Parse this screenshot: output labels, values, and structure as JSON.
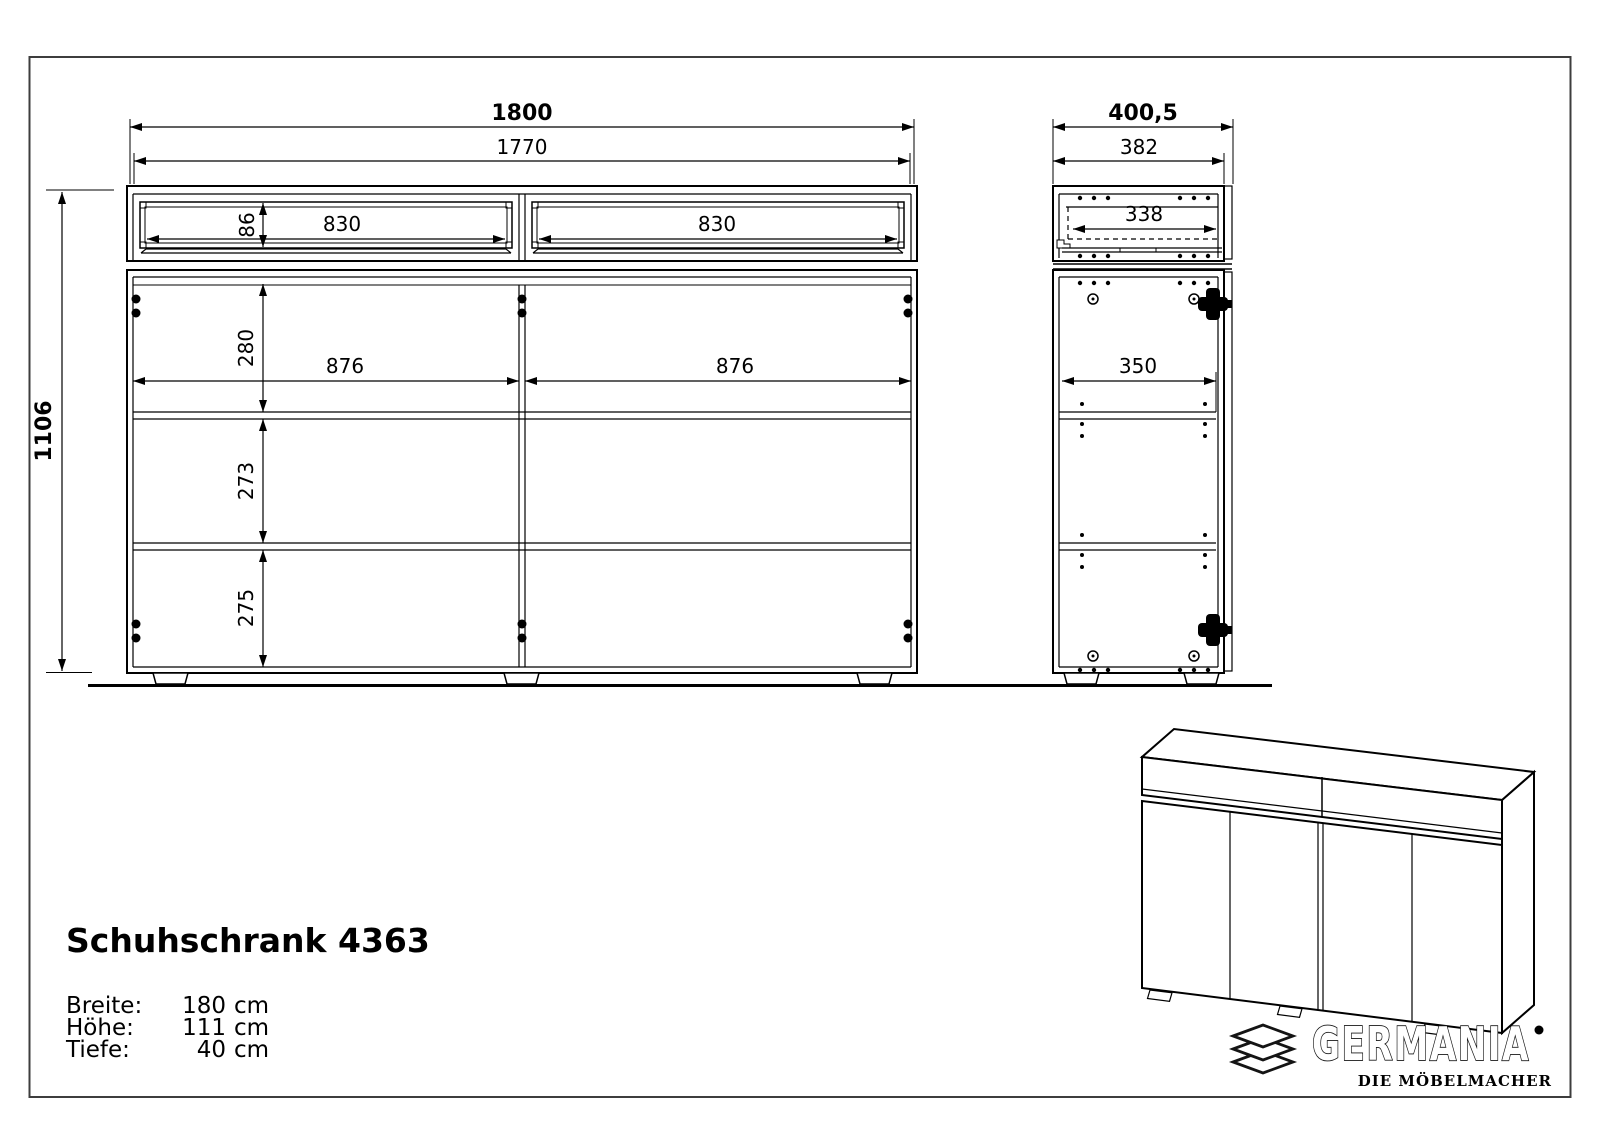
{
  "drawing": {
    "front_view": {
      "width_total": "1800",
      "width_inner": "1770",
      "drawer_front_height": "86",
      "drawer_width_left": "830",
      "drawer_width_right": "830",
      "top_compartment_height": "280",
      "door_width_left": "876",
      "door_width_right": "876",
      "middle_compartment_height": "273",
      "bottom_compartment_height": "275",
      "height_total": "1106"
    },
    "side_view": {
      "depth_total": "400,5",
      "depth_body": "382",
      "drawer_depth": "338",
      "shelf_depth": "350"
    }
  },
  "product": {
    "title": "Schuhschrank 4363",
    "specs": [
      {
        "label": "Breite:",
        "num": "180",
        "unit": "cm"
      },
      {
        "label": "Höhe:",
        "num": "111",
        "unit": "cm"
      },
      {
        "label": "Tiefe:",
        "num": "40",
        "unit": "cm"
      }
    ]
  },
  "brand": {
    "name": "GERMANIA",
    "tagline": "DIE MÖBELMACHER"
  },
  "colors": {
    "line": "#000000",
    "border": "#3d3d3d",
    "background": "#ffffff"
  }
}
